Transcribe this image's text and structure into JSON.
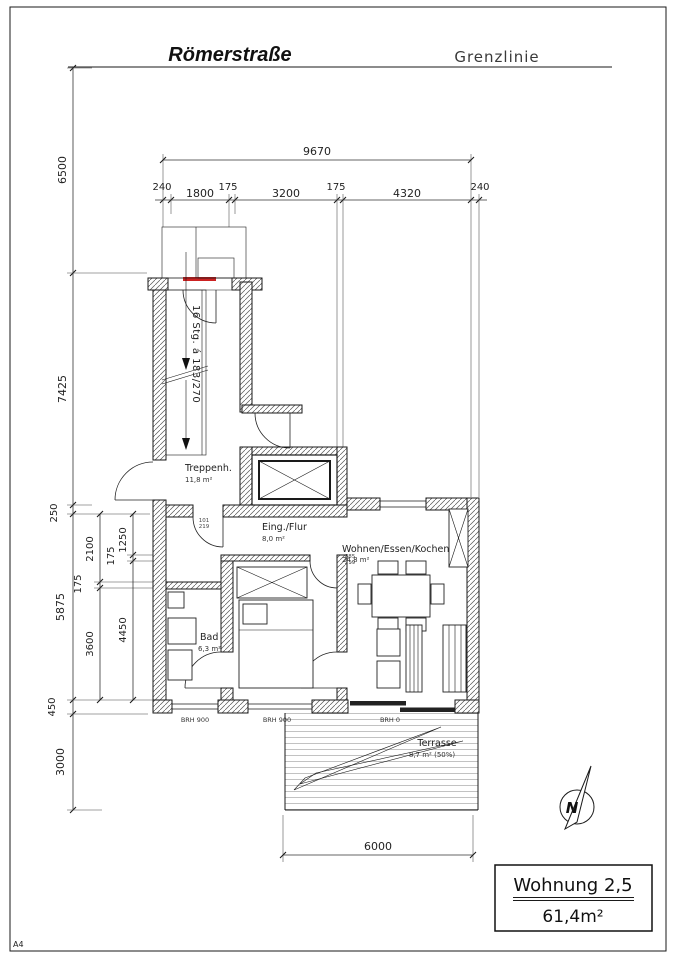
{
  "page": {
    "sheet_size": "A4"
  },
  "header": {
    "street_name": "Römerstraße",
    "boundary_label": "Grenzlinie"
  },
  "title_block": {
    "apartment": "Wohnung 2,5",
    "total_area": "61,4m²"
  },
  "compass": {
    "label": "N"
  },
  "rooms": [
    {
      "name": "Treppenh.",
      "area": "11,8 m²"
    },
    {
      "name": "Eing./Flur",
      "area": "8,0 m²"
    },
    {
      "name": "Wohnen/Essen/Kochen",
      "area": "24,8 m²"
    },
    {
      "name": "Bad",
      "area": "6,3 m²"
    },
    {
      "name": "Schlafen",
      "area": "13,8 m²"
    },
    {
      "name": "Terrasse",
      "area": "8,7 m² (50%)"
    }
  ],
  "stairs": {
    "flight_label": "16 Stg. á 183/270"
  },
  "dimensions": {
    "top_total": "9670",
    "top_segments": [
      "240",
      "1800",
      "175",
      "3200",
      "175",
      "4320",
      "240"
    ],
    "left_main": [
      "6500",
      "7425",
      "250",
      "5875",
      "450",
      "3000"
    ],
    "left_inner_a": [
      "2100",
      "175",
      "3600"
    ],
    "left_inner_b": [
      "1250",
      "175",
      "4450"
    ],
    "bottom_terrace": "6000"
  },
  "window_sills": [
    "BRH 900",
    "BRH 900",
    "BRH 0"
  ],
  "door_sizes": [
    [
      "101",
      "219"
    ],
    [
      "885",
      "219"
    ]
  ],
  "colors": {
    "line": "#1a1a1a",
    "door_marker": "#cc2222",
    "hatch": "#555555"
  }
}
